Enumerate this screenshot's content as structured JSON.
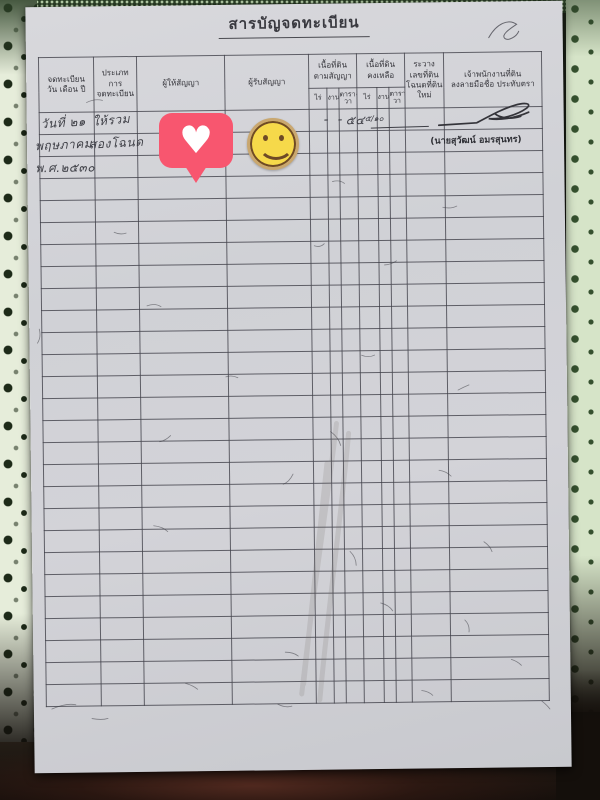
{
  "doc": {
    "title": "สารบัญจดทะเบียน"
  },
  "table": {
    "columns": [
      {
        "label": "จดทะเบียน\nวัน  เดือน  ปี"
      },
      {
        "label": "ประเภท\nการ\nจดทะเบียน"
      },
      {
        "label": "ผู้ให้สัญญา"
      },
      {
        "label": "ผู้รับสัญญา"
      },
      {
        "label": "เนื้อที่ดิน\nตามสัญญา",
        "sub": [
          "ไร่",
          "งาน",
          "ตาราง\nวา"
        ]
      },
      {
        "label": "เนื้อที่ดิน\nคงเหลือ",
        "sub": [
          "ไร่",
          "งาน",
          "ตาราง\nวา"
        ]
      },
      {
        "label": "ระวาง\nเลขที่ดิน\nโฉนดที่ดินใหม่"
      },
      {
        "label": "เจ้าพนักงานที่ดิน\nลงลายมือชื่อ  ประทับตรา"
      }
    ]
  },
  "entry": {
    "date_line1": "วันที่ ๒๑",
    "date_line2": "พฤษภาคม",
    "date_line3": "พ.ศ.๒๕๓๐",
    "type_line1": "ให้รวม",
    "type_line2": "สองโฉนด",
    "area_contract_rai": "-",
    "area_contract_ngan": "-",
    "area_contract_wa": "๕๔",
    "area_contract_wa_fraction": "๕/๑๐",
    "officer_name": "(นายสุวัฒน์  อมรสุนทร)"
  },
  "stickers": {
    "heart": {
      "name": "heart-reaction-sticker",
      "glyph": "♥",
      "bubble_color": "#f8566f",
      "heart_color": "#ffffff"
    },
    "smiley": {
      "name": "smiley-face-sticker",
      "face_color": "#f6d94a",
      "line_color": "#6e4a26",
      "ring_color": "#c9a76f"
    }
  },
  "colors": {
    "paper": "#d0d1d6",
    "grid_line": "#3e3e46",
    "ink": "#3e3f46",
    "lace_light": "#e6edda",
    "lace_dark": "#2b3f26",
    "fabric_red": "#50291f",
    "background_dark": "#161310"
  }
}
